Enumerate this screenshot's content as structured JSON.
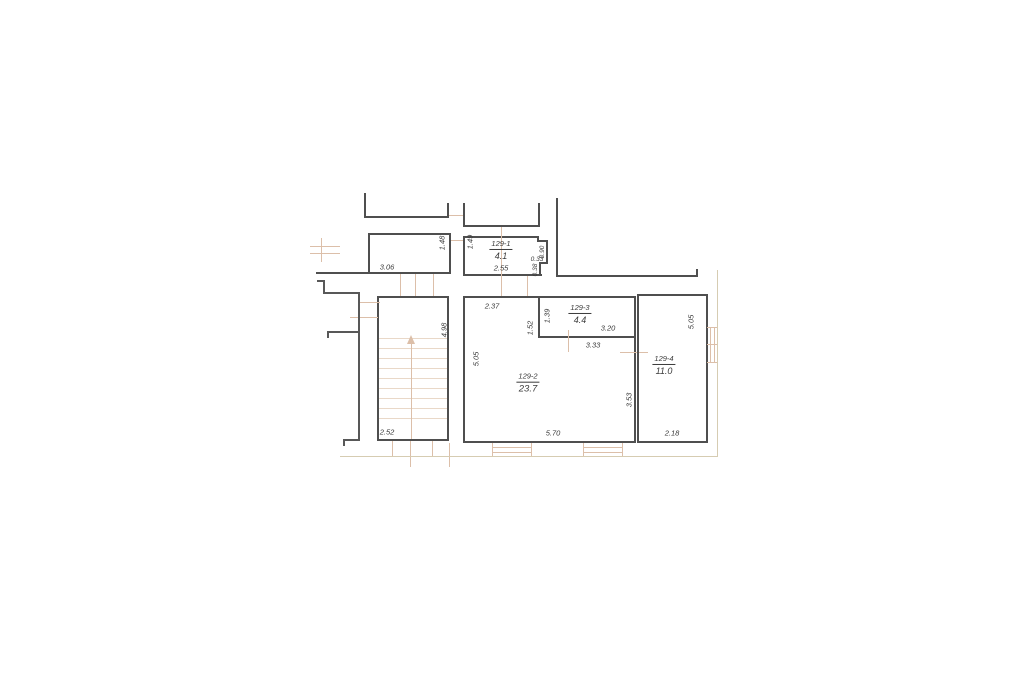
{
  "drawing": {
    "type": "floor-plan",
    "background": "#ffffff",
    "colors": {
      "wall": "#4f4f4f",
      "annotation": "#dcbfa9",
      "stair_tread": "#e9d8c8",
      "boundary": "#d6ccb2",
      "text": "#3a3a3a"
    },
    "rooms": {
      "r1": {
        "number": "129-1",
        "area": "4.1"
      },
      "r2": {
        "number": "129-2",
        "area": "23.7"
      },
      "r3": {
        "number": "129-3",
        "area": "4.4"
      },
      "r4": {
        "number": "129-4",
        "area": "11.0"
      }
    },
    "dims": {
      "a_w": "3.06",
      "a_h": "1.48",
      "b_h": "1.49",
      "b_w": "2.55",
      "b_niche_d": "0.90",
      "b_niche_w": "0.33",
      "b_jamb": "0.38",
      "stair_w": "2.52",
      "stair_h": "4.98",
      "c_top": "2.37",
      "c_left": "5.05",
      "c_bottom": "5.70",
      "c_right": "3.53",
      "c_inner_h": "1.52",
      "c_inner_w": "3.33",
      "r3_h": "1.39",
      "r3_w": "3.20",
      "r4_h": "5.05",
      "r4_w": "2.18"
    }
  }
}
